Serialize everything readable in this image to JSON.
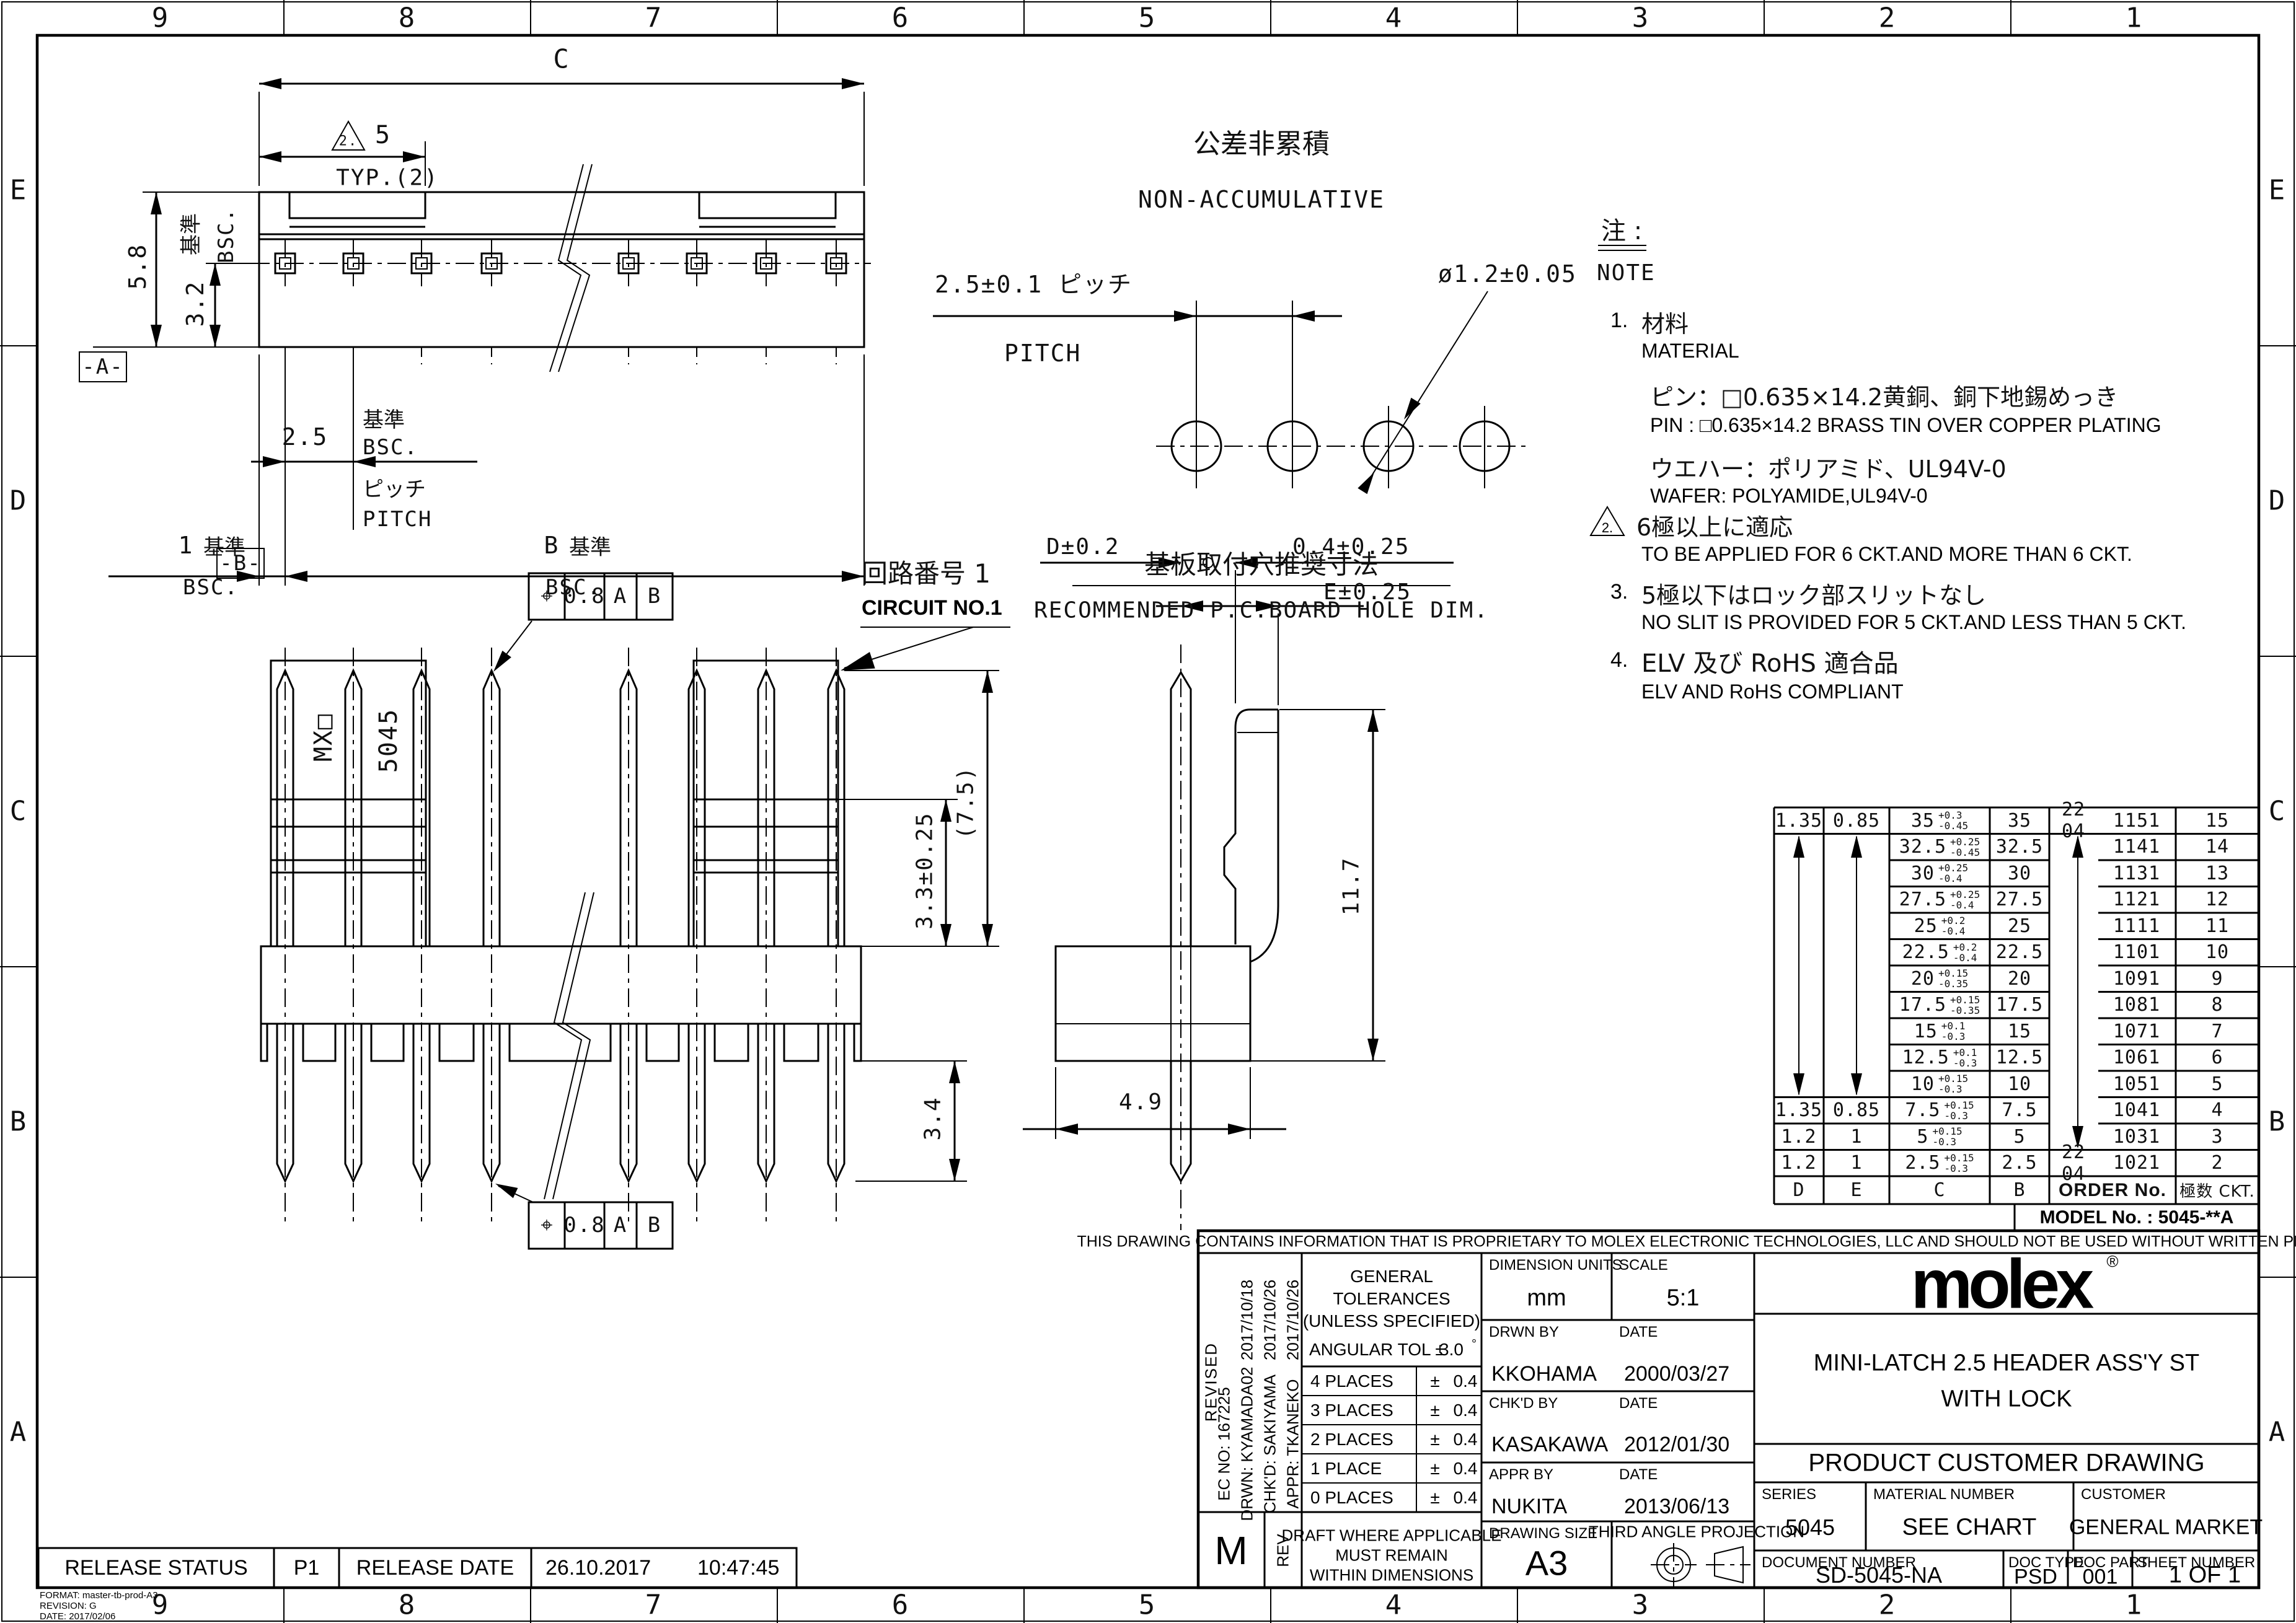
{
  "sheet": {
    "grid_cols": [
      "9",
      "8",
      "7",
      "6",
      "5",
      "4",
      "3",
      "2",
      "1"
    ],
    "grid_rows": [
      "E",
      "D",
      "C",
      "B",
      "A"
    ]
  },
  "labels": {
    "kijun": "基準",
    "bsc": "BSC."
  },
  "top_view": {
    "dim_c": "C",
    "tri_note": "2.",
    "dim_5": "5",
    "typ": "TYP.(2)",
    "dim_58": "5.8",
    "dim_32": "3.2",
    "datum_a": "-A-",
    "dim_25": "2.5",
    "pitch_jp": "ピッチ",
    "pitch_en": "PITCH",
    "dim_1": "1",
    "dim_b": "B"
  },
  "hole_view": {
    "title_jp": "公差非累積",
    "title_en": "NON-ACCUMULATIVE",
    "pitch": "2.5±0.1 ピッチ",
    "pitch_en": "PITCH",
    "dia": "ø1.2±0.05",
    "caption_jp": "基板取付穴推奨寸法",
    "caption_en": "RECOMMENDED P.C.BOARD HOLE DIM."
  },
  "front_view": {
    "datum_b": "-B-",
    "fcf_sym": "⌖",
    "fcf_tol": "0.8",
    "fcf_a": "A",
    "fcf_b": "B",
    "circuit_jp": "回路番号 1",
    "circuit_en": "CIRCUIT NO.1",
    "wall_mx": "MX□",
    "wall_series": "5045",
    "dim_33": "3.3±0.25",
    "dim_75": "(7.5)",
    "dim_34": "3.4"
  },
  "side_view": {
    "dim_d": "D±0.2",
    "dim_04": "0.4±0.25",
    "dim_e": "E±0.25",
    "dim_117": "11.7",
    "dim_49": "4.9"
  },
  "notes": {
    "header_jp": "注 :",
    "header_en": "NOTE",
    "n1": "1.",
    "n1_jp": "材料",
    "n1_en": "MATERIAL",
    "n1a_jp": "ピン：□0.635×14.2黄銅、銅下地錫めっき",
    "n1a_en": "PIN : □0.635×14.2 BRASS TIN OVER COPPER PLATING",
    "n1b_jp": "ウエハー：ポリアミド、UL94V-0",
    "n1b_en": "WAFER: POLYAMIDE,UL94V-0",
    "n2_tri": "2.",
    "n2_jp": "6極以上に適応",
    "n2_en": "TO BE APPLIED FOR 6 CKT.AND MORE THAN 6 CKT.",
    "n3": "3.",
    "n3_jp": "5極以下はロック部スリットなし",
    "n3_en": "NO SLIT IS PROVIDED FOR 5 CKT.AND LESS THAN 5 CKT.",
    "n4": "4.",
    "n4_jp": "ELV 及び RoHS 適合品",
    "n4_en": "ELV AND RoHS COMPLIANT"
  },
  "order_table": {
    "header": {
      "d": "D",
      "e": "E",
      "c": "C",
      "b": "B",
      "order": "ORDER No.",
      "ckt": "極数 CKT."
    },
    "model_no": "MODEL No. : 5045-**A",
    "rows": [
      {
        "d": "1.35",
        "e": "0.85",
        "c": "35",
        "tp": "+0.3",
        "tm": "-0.45",
        "b": "35",
        "op": "22 04",
        "on": "1151",
        "ckt": "15"
      },
      {
        "d": "",
        "e": "",
        "c": "32.5",
        "tp": "+0.25",
        "tm": "-0.45",
        "b": "32.5",
        "op": "",
        "on": "1141",
        "ckt": "14"
      },
      {
        "d": "",
        "e": "",
        "c": "30",
        "tp": "+0.25",
        "tm": "-0.4",
        "b": "30",
        "op": "",
        "on": "1131",
        "ckt": "13"
      },
      {
        "d": "",
        "e": "",
        "c": "27.5",
        "tp": "+0.25",
        "tm": "-0.4",
        "b": "27.5",
        "op": "",
        "on": "1121",
        "ckt": "12"
      },
      {
        "d": "",
        "e": "",
        "c": "25",
        "tp": "+0.2",
        "tm": "-0.4",
        "b": "25",
        "op": "",
        "on": "1111",
        "ckt": "11"
      },
      {
        "d": "",
        "e": "",
        "c": "22.5",
        "tp": "+0.2",
        "tm": "-0.4",
        "b": "22.5",
        "op": "",
        "on": "1101",
        "ckt": "10"
      },
      {
        "d": "",
        "e": "",
        "c": "20",
        "tp": "+0.15",
        "tm": "-0.35",
        "b": "20",
        "op": "",
        "on": "1091",
        "ckt": "9"
      },
      {
        "d": "",
        "e": "",
        "c": "17.5",
        "tp": "+0.15",
        "tm": "-0.35",
        "b": "17.5",
        "op": "",
        "on": "1081",
        "ckt": "8"
      },
      {
        "d": "",
        "e": "",
        "c": "15",
        "tp": "+0.1",
        "tm": "-0.3",
        "b": "15",
        "op": "",
        "on": "1071",
        "ckt": "7"
      },
      {
        "d": "",
        "e": "",
        "c": "12.5",
        "tp": "+0.1",
        "tm": "-0.3",
        "b": "12.5",
        "op": "",
        "on": "1061",
        "ckt": "6"
      },
      {
        "d": "",
        "e": "",
        "c": "10",
        "tp": "+0.15",
        "tm": "-0.3",
        "b": "10",
        "op": "",
        "on": "1051",
        "ckt": "5"
      },
      {
        "d": "1.35",
        "e": "0.85",
        "c": "7.5",
        "tp": "+0.15",
        "tm": "-0.3",
        "b": "7.5",
        "op": "",
        "on": "1041",
        "ckt": "4"
      },
      {
        "d": "1.2",
        "e": "1",
        "c": "5",
        "tp": "+0.15",
        "tm": "-0.3",
        "b": "5",
        "op": "",
        "on": "1031",
        "ckt": "3"
      },
      {
        "d": "1.2",
        "e": "1",
        "c": "2.5",
        "tp": "+0.15",
        "tm": "-0.3",
        "b": "2.5",
        "op": "22 04",
        "on": "1021",
        "ckt": "2"
      }
    ]
  },
  "title_block": {
    "proprietary": "THIS DRAWING CONTAINS INFORMATION THAT IS PROPRIETARY TO MOLEX ELECTRONIC TECHNOLOGIES, LLC AND SHOULD NOT BE USED WITHOUT WRITTEN PERMISSION",
    "revised": "REVISED",
    "rev_dates": [
      "2017/10/18",
      "2017/10/26",
      "2017/10/26"
    ],
    "ec_no": "EC NO:  167225",
    "drwn": "DRWN:  KYAMADA02",
    "chkd": "CHK'D:  SAKIYAMA",
    "appr": "APPR:  TKANEKO",
    "rev_letter": "M",
    "rev_label": "REV",
    "tol_title1": "GENERAL",
    "tol_title2": "TOLERANCES",
    "tol_title3": "(UNLESS SPECIFIED)",
    "angular": "ANGULAR TOL ±",
    "angular_val": "3.0",
    "angular_deg": "°",
    "tol_rows": [
      {
        "label": "4 PLACES",
        "pm": "±",
        "val": "0.4"
      },
      {
        "label": "3 PLACES",
        "pm": "±",
        "val": "0.4"
      },
      {
        "label": "2 PLACES",
        "pm": "±",
        "val": "0.4"
      },
      {
        "label": "1 PLACE",
        "pm": "±",
        "val": "0.4"
      },
      {
        "label": "0 PLACES",
        "pm": "±",
        "val": "0.4"
      }
    ],
    "draft1": "DRAFT WHERE APPLICABLE",
    "draft2": "MUST REMAIN",
    "draft3": "WITHIN DIMENSIONS",
    "dim_units_label": "DIMENSION UNITS",
    "dim_units": "mm",
    "scale_label": "SCALE",
    "scale": "5:1",
    "drwn_by_label": "DRWN BY",
    "date_label": "DATE",
    "drwn_by": "KKOHAMA",
    "drwn_date": "2000/03/27",
    "chkd_by_label": "CHK'D BY",
    "chkd_by": "KASAKAWA",
    "chkd_date": "2012/01/30",
    "appr_by_label": "APPR BY",
    "appr_by": "NUKITA",
    "appr_date": "2013/06/13",
    "size_label": "DRAWING SIZE",
    "size": "A3",
    "projection": "THIRD ANGLE PROJECTION",
    "logo": "molex",
    "logo_r": "®",
    "title1": "MINI-LATCH 2.5 HEADER ASS'Y ST",
    "title2": "WITH LOCK",
    "doc_title": "PRODUCT CUSTOMER DRAWING",
    "series_label": "SERIES",
    "series": "5045",
    "material_label": "MATERIAL NUMBER",
    "material": "SEE CHART",
    "customer_label": "CUSTOMER",
    "customer": "GENERAL MARKET",
    "docnum_label": "DOCUMENT NUMBER",
    "docnum": "SD-5045-NA",
    "doctype_label": "DOC TYPE",
    "doctype": "PSD",
    "docpart_label": "DOC PART",
    "docpart": "001",
    "sheet_label": "SHEET NUMBER",
    "sheet": "1 OF 1"
  },
  "release_bar": {
    "status_label": "RELEASE STATUS",
    "status": "P1",
    "date_label": "RELEASE DATE",
    "date": "26.10.2017",
    "time": "10:47:45"
  },
  "format_note": {
    "line1": "FORMAT: master-tb-prod-A3",
    "line2": "REVISION: G",
    "line3": "DATE: 2017/02/06"
  }
}
